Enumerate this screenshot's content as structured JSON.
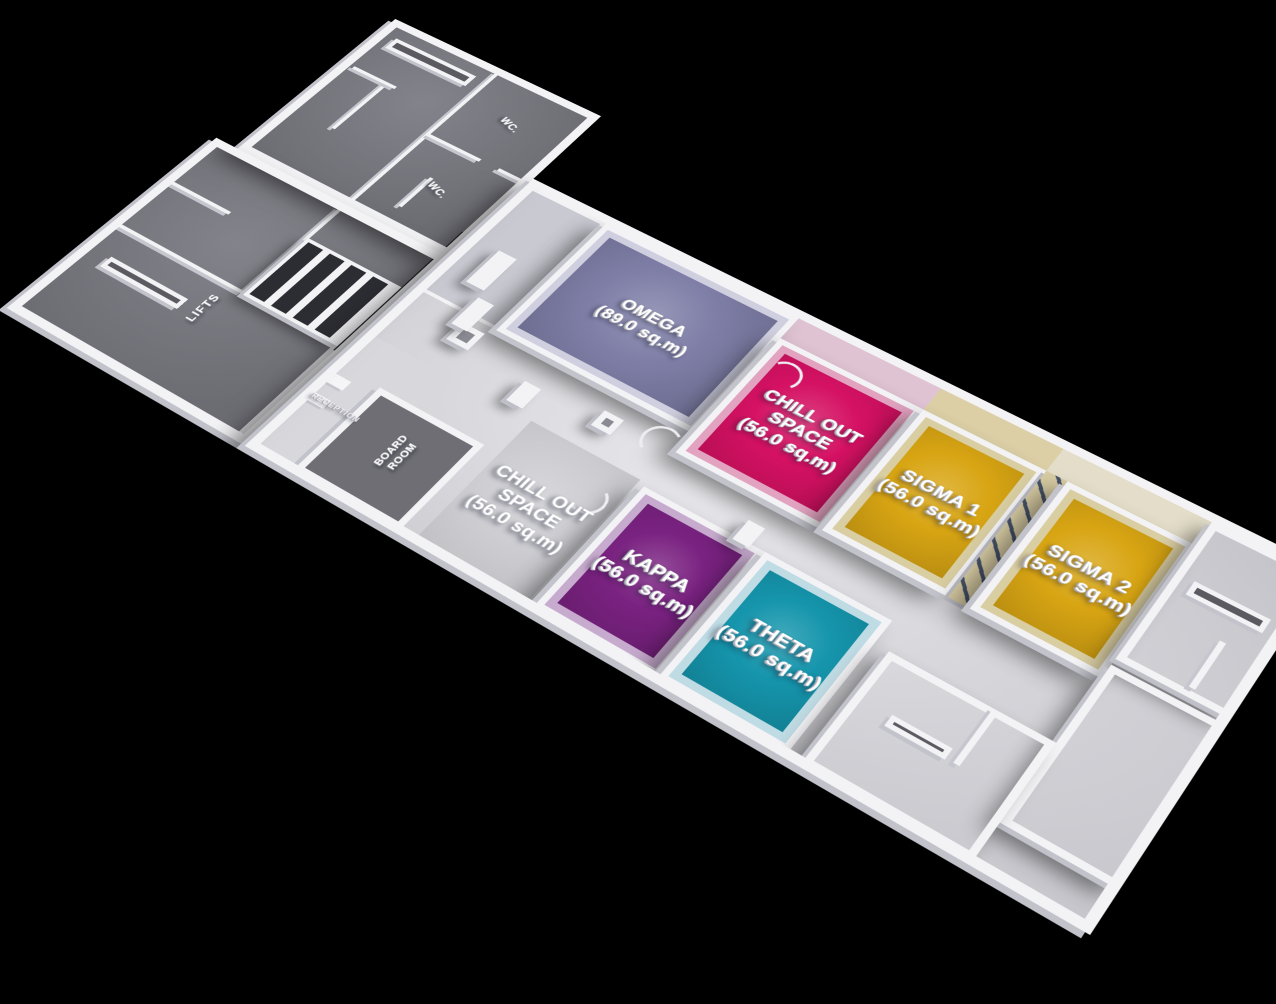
{
  "scene": {
    "background": "#000000",
    "wall_color": "#f3f3f6",
    "corridor_floor_color": "#d0d0d5",
    "dark_zone_floor_color": "#6c6c73"
  },
  "rooms": [
    {
      "id": "omega",
      "name": "OMEGA",
      "area": "(89.0 sq.m)",
      "floor": "#7e7ea7",
      "wall": "#cfcfdf"
    },
    {
      "id": "chill-out-space-1",
      "name": "CHILL OUT SPACE",
      "area": "(56.0 sq.m)",
      "floor": "#d51163",
      "wall": "#e2a3c0"
    },
    {
      "id": "sigma-1",
      "name": "SIGMA 1",
      "area": "(56.0 sq.m)",
      "floor": "#d8a513",
      "wall": "#d9cda2"
    },
    {
      "id": "sigma-2",
      "name": "SIGMA 2",
      "area": "(56.0 sq.m)",
      "floor": "#d8a513",
      "wall": "#d9cda2"
    },
    {
      "id": "chill-out-space-2",
      "name": "CHILL OUT SPACE",
      "area": "(56.0 sq.m)",
      "floor": "#cbcbd0",
      "wall": "#f3f3f6"
    },
    {
      "id": "kappa",
      "name": "KAPPA",
      "area": "(56.0 sq.m)",
      "floor": "#7a2281",
      "wall": "#c7abce"
    },
    {
      "id": "theta",
      "name": "THETA",
      "area": "(56.0 sq.m)",
      "floor": "#1595ac",
      "wall": "#bfdbe4"
    }
  ],
  "facilities": {
    "board_room": "BOARD ROOM",
    "lifts": "LIFTS",
    "reception": "RECEPTION",
    "wc_1": "WC.",
    "wc_2": "WC."
  }
}
